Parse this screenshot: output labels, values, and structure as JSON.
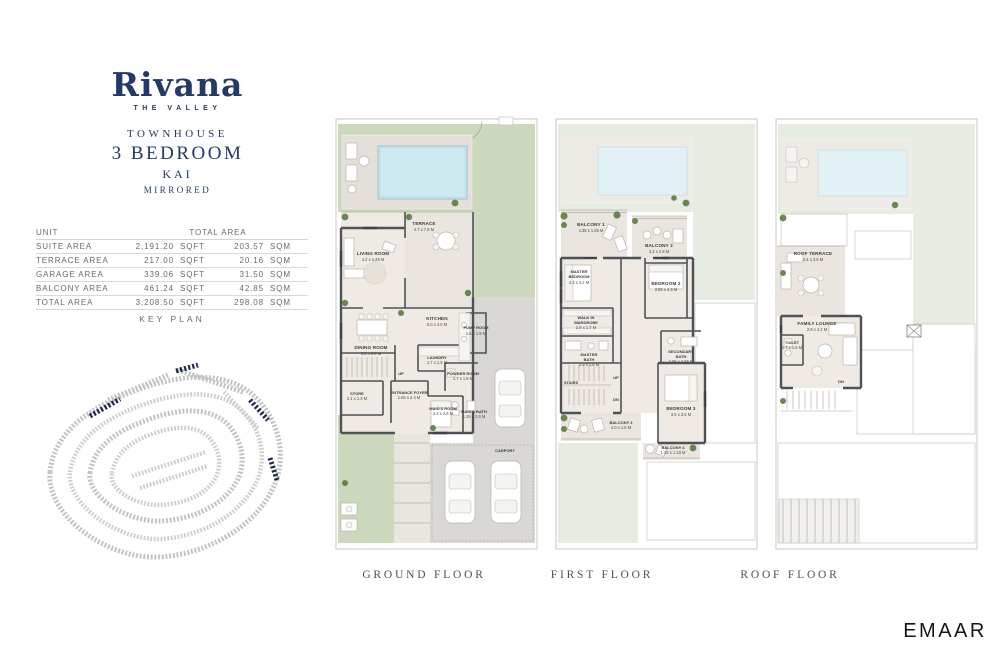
{
  "brand": {
    "logo": "Rivana",
    "sub": "THE VALLEY"
  },
  "unit": {
    "line1": "TOWNHOUSE",
    "line2": "3 BEDROOM",
    "line3": "KAI",
    "line4": "MIRRORED"
  },
  "area_table": {
    "col_unit": "UNIT",
    "col_total": "TOTAL AREA",
    "rows": [
      {
        "label": "SUITE AREA",
        "sqft": "2,191.20",
        "sqft_unit": "SQFT",
        "sqm": "203.57",
        "sqm_unit": "SQM"
      },
      {
        "label": "TERRACE AREA",
        "sqft": "217.00",
        "sqft_unit": "SQFT",
        "sqm": "20.16",
        "sqm_unit": "SQM"
      },
      {
        "label": "GARAGE AREA",
        "sqft": "339.06",
        "sqft_unit": "SQFT",
        "sqm": "31.50",
        "sqm_unit": "SQM"
      },
      {
        "label": "BALCONY AREA",
        "sqft": "461.24",
        "sqft_unit": "SQFT",
        "sqm": "42.85",
        "sqm_unit": "SQM"
      },
      {
        "label": "TOTAL AREA",
        "sqft": "3,208.50",
        "sqft_unit": "SQFT",
        "sqm": "298.08",
        "sqm_unit": "SQM"
      }
    ]
  },
  "key_plan_title": "KEY PLAN",
  "floors": [
    {
      "caption": "GROUND FLOOR",
      "rooms": {
        "terrace": {
          "name": "TERRACE",
          "dims": "4.7 x 7.8 M"
        },
        "living": {
          "name": "LIVING ROOM",
          "dims": "4.2 x 4.25 M"
        },
        "kitchen": {
          "name": "KITCHEN",
          "dims": "5.0 x 3.0 M"
        },
        "dining": {
          "name": "DINING ROOM",
          "dims": "3.3 x 2.8 M"
        },
        "pump": {
          "name": "PUMP ROOM",
          "dims": "1.5 x 1.9 M"
        },
        "laundry": {
          "name": "LAUNDRY",
          "dims": "1.7 x 1.9 M"
        },
        "powder": {
          "name": "POWDER ROOM",
          "dims": "1.7 x 1.9 M"
        },
        "store": {
          "name": "STORE",
          "dims": "2.1 x 1.3 M"
        },
        "foyer": {
          "name": "ENTRANCE FOYER",
          "dims": "1.65 x 2.4 M"
        },
        "maids": {
          "name": "MAID'S ROOM",
          "dims": "2.2 x 2.6 M"
        },
        "maidsbath": {
          "name": "MAID'S BATH",
          "dims": "1.25 x 2.6 M"
        },
        "carport": {
          "name": "CARPORT"
        },
        "up": {
          "name": "UP"
        }
      }
    },
    {
      "caption": "FIRST FLOOR",
      "rooms": {
        "balcony1": {
          "name": "BALCONY 1",
          "dims": "4.35 x 1.85 M"
        },
        "balcony2": {
          "name": "BALCONY 2",
          "dims": "3.2 x 2.8 M"
        },
        "master": {
          "name": "MASTER BEDROOM",
          "dims": "4.2 x 3.2 M"
        },
        "bedroom2": {
          "name": "BEDROOM 2",
          "dims": "3.55 x 4.5 M"
        },
        "wardrobe": {
          "name": "WALK IN WARDROBE",
          "dims": "2.9 x 1.7 M"
        },
        "masterbath": {
          "name": "MASTER BATH",
          "dims": "2.9 x 1.9 M"
        },
        "secondarybath": {
          "name": "SECONDARY BATH",
          "dims": "2.05 x 2.85 M"
        },
        "bedroom3": {
          "name": "BEDROOM 3",
          "dims": "3.5 x 3.6 M"
        },
        "stairs": {
          "name": "STAIRS"
        },
        "up": {
          "name": "UP"
        },
        "dn": {
          "name": "DN"
        },
        "balcony3": {
          "name": "BALCONY 3",
          "dims": "4.0 x 1.5 M"
        },
        "balcony4": {
          "name": "BALCONY 4",
          "dims": "1.29 x 1.18 M"
        }
      }
    },
    {
      "caption": "ROOF FLOOR",
      "rooms": {
        "roofterrace": {
          "name": "ROOF TERRACE",
          "dims": "4.4 x 3.9 M"
        },
        "familylounge": {
          "name": "FAMILY LOUNGE",
          "dims": "2.9 x 4.2 M"
        },
        "toilet": {
          "name": "TOILET",
          "dims": "1.7 x 1.6 M"
        },
        "dn": {
          "name": "DN"
        }
      }
    }
  ],
  "developer_logo": "EMAAR",
  "colors": {
    "accent_navy": "#233a66",
    "garden_green": "#cbd8bb",
    "pool_blue": "#c2e4ec"
  }
}
